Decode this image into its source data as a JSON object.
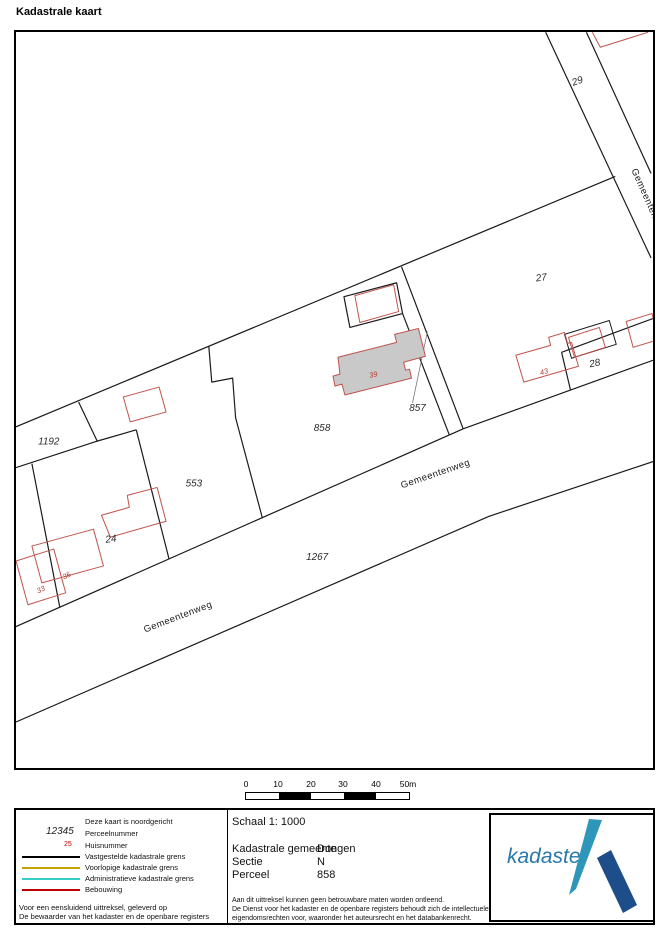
{
  "page_title": "Kadastrale kaart",
  "map": {
    "parcels": {
      "p29": "29",
      "p27": "27",
      "p28": "28",
      "p857": "857",
      "p858": "858",
      "p1192": "1192",
      "p553": "553",
      "p24": "24",
      "p1267": "1267"
    },
    "houses": {
      "h39": "39",
      "h43": "43",
      "h35": "35",
      "h33": "33"
    },
    "roads": {
      "bottom_left": "Gemeentenweg",
      "center": "Gemeentenweg",
      "right_edge": "Gemeentenweg"
    }
  },
  "scalebar": {
    "t0": "0",
    "t1": "10",
    "t2": "20",
    "t3": "30",
    "t4": "40",
    "t5": "50m"
  },
  "legend": {
    "north_note": "Deze kaart is noordgericht",
    "parcel_sample": "12345",
    "parcel_label": "Perceelnummer",
    "house_sample": "25",
    "house_label": "Huisnummer",
    "line1": "Vastgestelde kadastrale grens",
    "line2": "Voorlopige kadastrale grens",
    "line3": "Administratieve kadastrale grens",
    "line4": "Bebouwing",
    "footer1": "Voor een eensluidend uittreksel, geleverd op",
    "footer2": "De bewaarder van het kadaster en de openbare registers"
  },
  "info": {
    "scale": "Schaal 1: 1000",
    "municipality_label": "Kadastrale gemeente",
    "municipality_value": "Dongen",
    "section_label": "Sectie",
    "section_value": "N",
    "parcel_label": "Perceel",
    "parcel_value": "858",
    "disclaimer1": "Aan dit uittreksel kunnen geen betrouwbare maten worden ontleend.",
    "disclaimer2": "De Dienst voor het kadaster en de openbare registers behoudt zich de intellectuele",
    "disclaimer3": "eigendomsrechten voor, waaronder het auteursrecht en het databankenrecht."
  },
  "logo": {
    "brand": "kadaster"
  },
  "colors": {
    "boundary_black": "#1a1a1a",
    "building_outline": "#c0524a",
    "building_fill": "#c9c9c9",
    "legend_red": "#c00000",
    "legend_orange": "#c8a000",
    "legend_cyan": "#35d0c5",
    "logo_teal": "#2e96b8",
    "logo_navy": "#1d4e8a",
    "logo_text": "#2878aa"
  }
}
